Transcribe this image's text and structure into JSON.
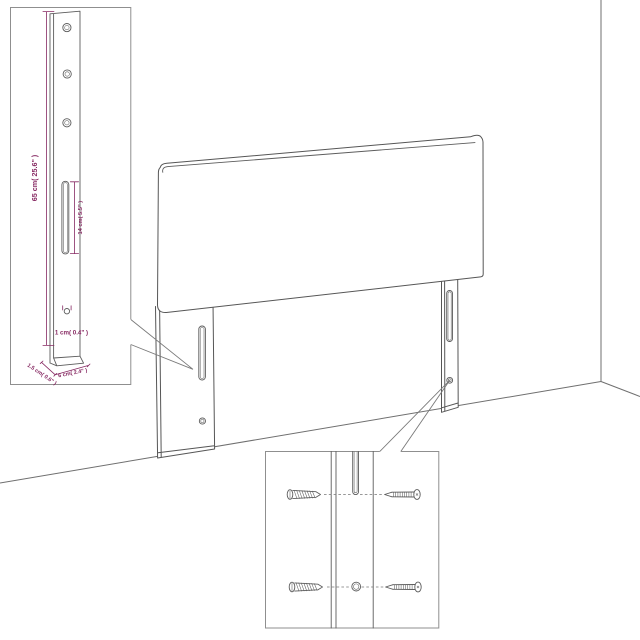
{
  "scene": {
    "description": "Technical line drawing of an upholstered headboard with two mounting legs standing in a room corner, with two magnified detail insets",
    "background_color": "#ffffff",
    "line_color": "#565656",
    "wall_line_color": "#6f6f6f",
    "dimension_color": "#872a63",
    "inset_border_color": "#8f8f8f"
  },
  "leg_detail_inset": {
    "dim_height": "65 cm( 25.6\" )",
    "dim_slot": "14 cm( 5.5\" )",
    "dim_hole": "1 cm( 0.4\" )",
    "dim_depth": "1.5 cm( 0.6\" )",
    "dim_width": "6 cm( 2.4\" )",
    "icons": [
      "mounting-hole-icon",
      "adjustment-slot-icon",
      "screw-hole-icon"
    ]
  },
  "hardware_detail_inset": {
    "icons": [
      "slot-end-icon",
      "round-hole-icon",
      "bolt-screw-icon",
      "tapping-screw-icon"
    ]
  }
}
